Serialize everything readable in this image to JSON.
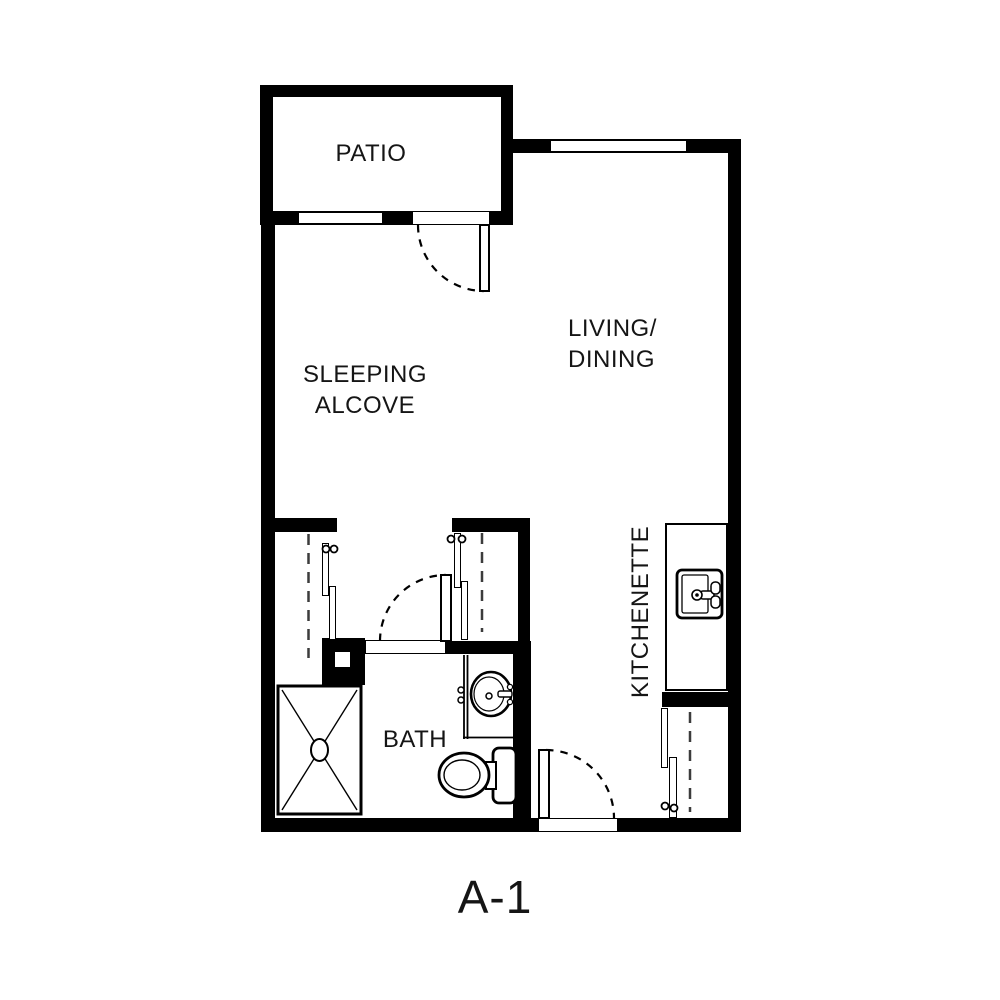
{
  "plan": {
    "title": "A-1",
    "labels": {
      "patio": "PATIO",
      "sleeping_line1": "SLEEPING",
      "sleeping_line2": "ALCOVE",
      "living_line1": "LIVING/",
      "living_line2": "DINING",
      "kitchenette": "KITCHENETTE",
      "bath": "BATH"
    },
    "fixtures": {
      "shower": "shower-pan",
      "kitchen_sink": "kitchen-sink",
      "bath_sink": "vanity-sink",
      "toilet": "toilet"
    },
    "colors": {
      "wall": "#000000",
      "floor": "#ffffff"
    }
  }
}
